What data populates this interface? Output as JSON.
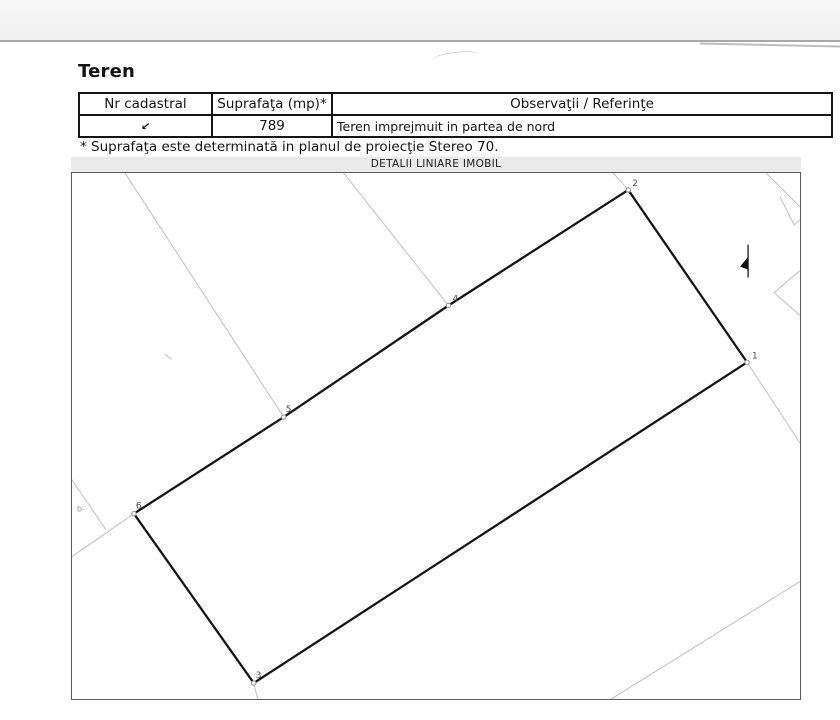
{
  "document": {
    "section_title": "Teren",
    "footnote": "* Suprafaţa este determinată in planul de proiecţie Stereo 70."
  },
  "table": {
    "headers": {
      "nr": "Nr cadastral",
      "area": "Suprafaţa (mp)*",
      "obs": "Observaţii / Referinţe"
    },
    "row": {
      "nr_mark": "↙",
      "area": "789",
      "obs": "Teren imprejmuit in partea de nord"
    }
  },
  "plan": {
    "title": "DETALII LINIARE IMOBIL",
    "colors": {
      "parcel_line": "#161616",
      "neighbor_line": "#c4c4c4",
      "vertex_marker": "#8f8f8f",
      "vertex_label": "#4a4a4a",
      "strip_bg": "#eaeaea",
      "frame": "#5c5c5c"
    },
    "parcel": {
      "points": [
        [
          557,
          17
        ],
        [
          676,
          190
        ],
        [
          182,
          512
        ],
        [
          62,
          342
        ],
        [
          212,
          245
        ],
        [
          377,
          133
        ]
      ]
    },
    "vertices": [
      {
        "label": "1",
        "x": 676,
        "y": 190,
        "dx": 5,
        "dy": -4
      },
      {
        "label": "2",
        "x": 557,
        "y": 17,
        "dx": 4,
        "dy": -4
      },
      {
        "label": "3",
        "x": 182,
        "y": 512,
        "dx": 2,
        "dy": -5
      },
      {
        "label": "4",
        "x": 377,
        "y": 133,
        "dx": 4,
        "dy": -4
      },
      {
        "label": "5",
        "x": 212,
        "y": 245,
        "dx": 2,
        "dy": -5
      },
      {
        "label": "6",
        "x": 62,
        "y": 342,
        "dx": 2,
        "dy": -5
      }
    ],
    "neighbor_lines": [
      [
        [
          53,
          0
        ],
        [
          212,
          245
        ]
      ],
      [
        [
          272,
          0
        ],
        [
          377,
          133
        ]
      ],
      [
        [
          542,
          0
        ],
        [
          557,
          17
        ]
      ],
      [
        [
          695,
          0
        ],
        [
          729,
          34
        ]
      ],
      [
        [
          709,
          24
        ],
        [
          723,
          52
        ],
        [
          729,
          47
        ]
      ],
      [
        [
          729,
          98
        ],
        [
          703,
          120
        ],
        [
          729,
          143
        ]
      ],
      [
        [
          676,
          190
        ],
        [
          729,
          271
        ]
      ],
      [
        [
          729,
          410
        ],
        [
          540,
          528
        ]
      ],
      [
        [
          0,
          308
        ],
        [
          34,
          358
        ]
      ],
      [
        [
          0,
          385
        ],
        [
          62,
          342
        ]
      ],
      [
        [
          182,
          512
        ],
        [
          186,
          528
        ]
      ],
      [
        [
          93,
          182
        ],
        [
          100,
          187
        ]
      ]
    ],
    "north_mark": {
      "line": [
        [
          677,
          72
        ],
        [
          677,
          105
        ]
      ],
      "triangle": [
        [
          669,
          94
        ],
        [
          677,
          84
        ],
        [
          677,
          97
        ]
      ]
    },
    "tiny_label": {
      "text": "b-",
      "x": 5,
      "y": 340
    }
  }
}
